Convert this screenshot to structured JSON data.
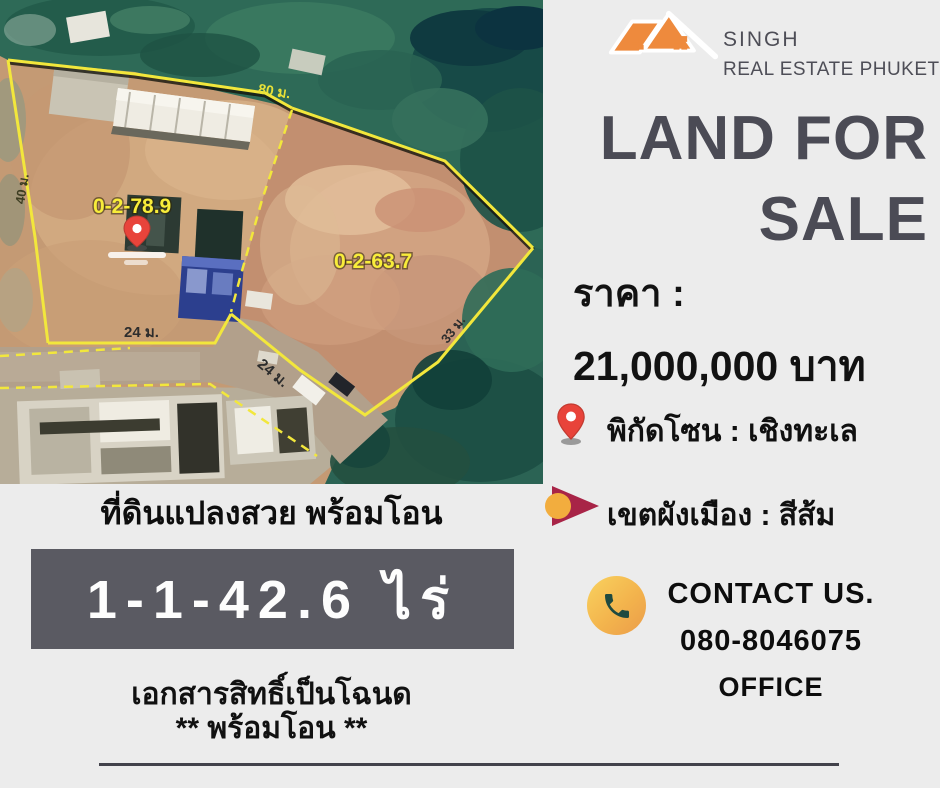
{
  "brand": {
    "line1": "SINGH",
    "line2": "REAL ESTATE PHUKET"
  },
  "title": {
    "line1": "LAND FOR",
    "line2": "SALE"
  },
  "price": {
    "label": "ราคา :",
    "value": "21,000,000 บาท"
  },
  "features": [
    {
      "icon": "location-pin-icon",
      "text": "พิกัดโซน : เชิงทะเล"
    },
    {
      "icon": "zone-arrow-icon",
      "text": "เขตผังเมือง : สีส้ม"
    }
  ],
  "contact": {
    "heading": "CONTACT US.",
    "phone": "080-8046075",
    "subheading": "OFFICE"
  },
  "land": {
    "caption": "ที่ดินแปลงสวย พร้อมโอน",
    "area_badge": "1-1-42.6 ไร่",
    "deed_line1": "เอกสารสิทธิ์เป็นโฉนด",
    "deed_line2": "** พร้อมโอน **"
  },
  "map": {
    "plot1_area_label": "0-2-78.9",
    "plot2_area_label": "0-2-63.7",
    "dim_top": "80 ม.",
    "dim_left": "40 ม.",
    "dim_bottom_left": "24 ม.",
    "dim_bottom_right": "24 ม.",
    "dim_right": "33 ม."
  },
  "colors": {
    "accent_orange": "#EE8A3D",
    "title_gray": "#4B4B55",
    "badge_gray": "#5A5A62",
    "pin_red": "#E8443B",
    "arrow_crimson": "#A82447",
    "circle_yellow": "#F2AD3E",
    "phone_green": "#1F4A40",
    "boundary_yellow": "#F2E73C",
    "background": "#ECECEC"
  }
}
